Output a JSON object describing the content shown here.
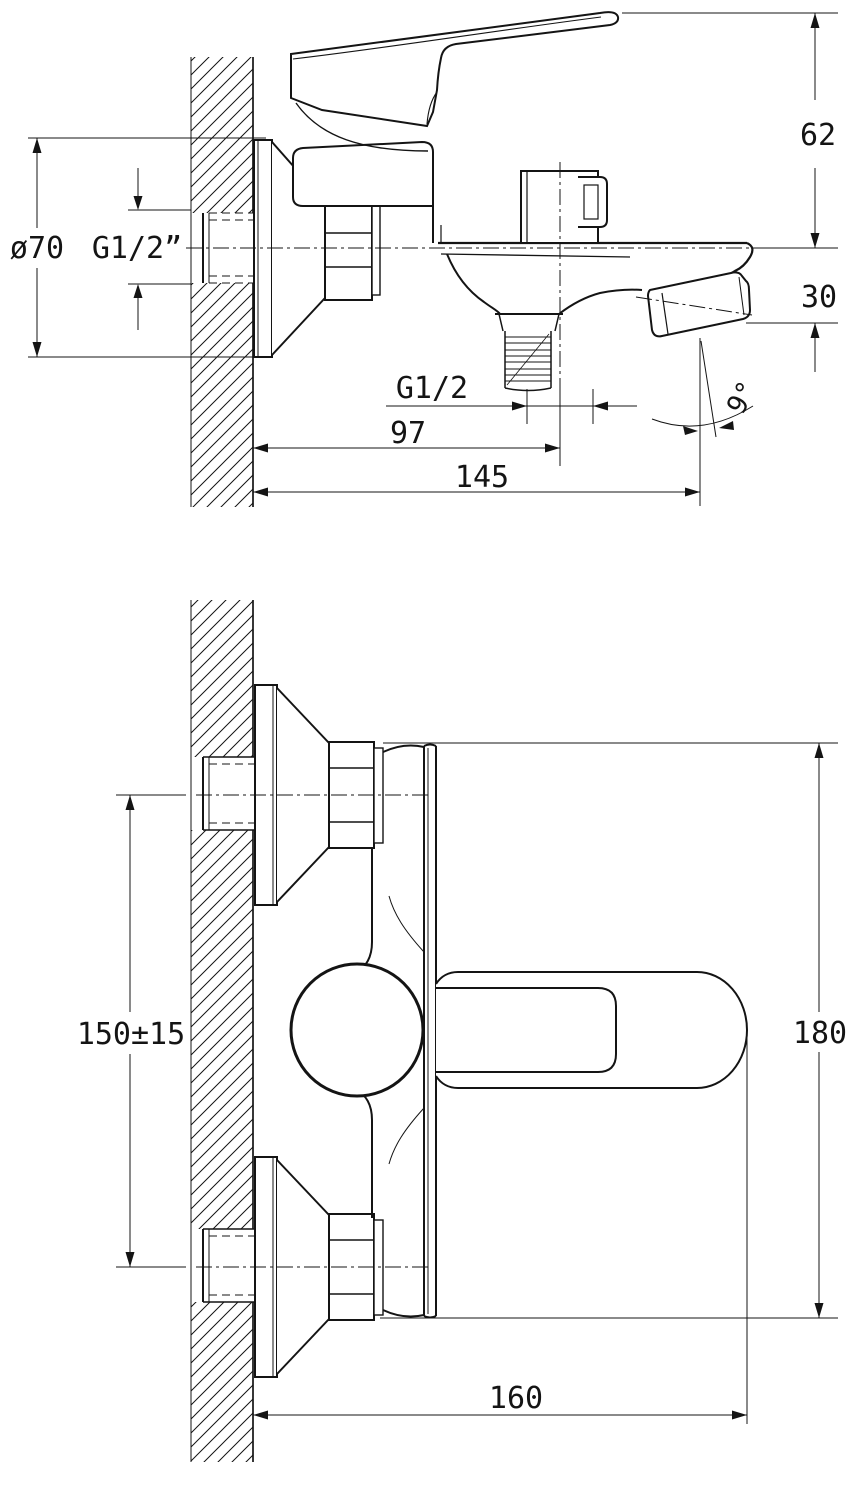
{
  "drawing": {
    "type": "technical-dimension-drawing",
    "subject": "wall-mounted single-lever bath mixer faucet, side view and front view",
    "background_color": "#ffffff",
    "line_color": "#141414",
    "labels": {
      "side_view": {
        "escutcheon_diameter": "ø70",
        "wall_connection_thread": "G1/2”",
        "handle_height": "62",
        "spout_drop": "30",
        "shower_outlet_thread": "G1/2",
        "outlet_center_distance": "97",
        "spout_reach": "145",
        "spout_angle": "9°"
      },
      "front_view": {
        "mounting_centers": "150±15",
        "overall_height": "180",
        "overall_length": "160"
      }
    }
  }
}
